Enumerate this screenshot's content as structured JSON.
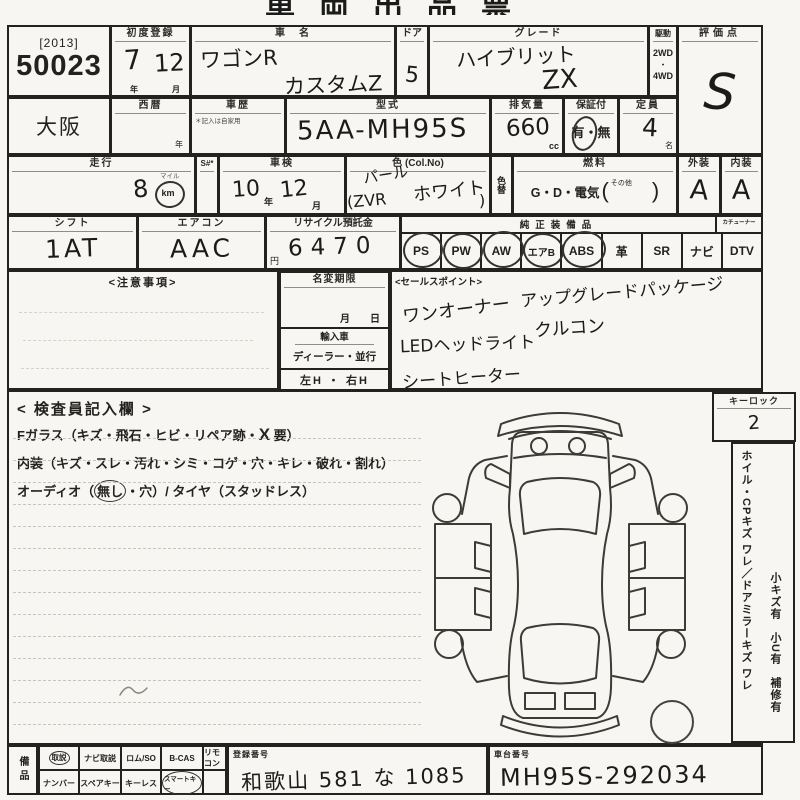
{
  "colors": {
    "paper": "#f7f6f2",
    "ink": "#1b1b19",
    "line": "#23221f",
    "faint_line": "#c7c6be"
  },
  "title": "車両出品票",
  "lot": {
    "year_bracket": "[2013]",
    "number": "50023"
  },
  "auction_house": "大阪",
  "first_registration": {
    "label": "初度登録",
    "year": "7",
    "month": "12",
    "year_unit": "年",
    "month_unit": "月"
  },
  "car_name": {
    "label": "車　名",
    "line1": "ワゴンR",
    "line2": "カスタムZ"
  },
  "door": {
    "label": "ドア",
    "value": "5"
  },
  "grade": {
    "label": "グレード",
    "line1": "ハイブリット",
    "line2": "ZX"
  },
  "drive": {
    "label": "駆動",
    "opt1": "2WD",
    "dot": "・",
    "opt2": "4WD"
  },
  "score": {
    "label": "評価点",
    "value": "S"
  },
  "seireki": {
    "label": "西暦",
    "unit": "年"
  },
  "car_history": {
    "label": "車歴",
    "note": "＊記入は自家用"
  },
  "model_code": {
    "label": "型式",
    "value": "5AA-MH95S"
  },
  "displacement": {
    "label": "排気量",
    "value": "660",
    "unit": "cc"
  },
  "warranty": {
    "label": "保証付",
    "value": "有・無"
  },
  "capacity": {
    "label": "定員",
    "value": "4",
    "unit": "名"
  },
  "mileage": {
    "label": "走行",
    "s_label": "S#*",
    "value": "8",
    "mile_label": "マイル",
    "km_label": "km"
  },
  "shaken": {
    "label": "車検",
    "year": "10",
    "year_unit": "年",
    "month": "12",
    "month_unit": "月"
  },
  "color": {
    "label": "色 (Col.No)",
    "line1": "パール",
    "line2": "ホワイト",
    "code": "(ZVR",
    "close_paren": ")"
  },
  "color_change_label": "色替",
  "fuel": {
    "label": "燃料",
    "value": "G・D・電気",
    "open": "(",
    "other": "その他",
    "close": ")"
  },
  "exterior": {
    "label": "外装",
    "value": "A"
  },
  "interior": {
    "label": "内装",
    "value": "A"
  },
  "shift": {
    "label": "シフト",
    "value": "1AT"
  },
  "aircon": {
    "label": "エアコン",
    "value": "AAC"
  },
  "recycle": {
    "label": "リサイクル預託金",
    "value": "6470",
    "unit": "円"
  },
  "equipment": {
    "label": "純正装備品",
    "tuner_label": "カチューナー",
    "items": [
      {
        "label": "PS",
        "circled": true
      },
      {
        "label": "PW",
        "circled": true
      },
      {
        "label": "AW",
        "circled": true
      },
      {
        "label": "エアB",
        "circled": true
      },
      {
        "label": "ABS",
        "circled": true
      },
      {
        "label": "革",
        "circled": false
      },
      {
        "label": "SR",
        "circled": false
      },
      {
        "label": "ナビ",
        "circled": false
      },
      {
        "label": "DTV",
        "circled": false
      }
    ]
  },
  "notes": {
    "label": "<注意事項>"
  },
  "name_change": {
    "label": "名変期限",
    "date_line": "月　　日",
    "import_label": "輸入車",
    "dealer_line": "ディーラー・並行",
    "handle_line": "左H ・ 右H"
  },
  "sales_points": {
    "label": "<セールスポイント>",
    "items": [
      "アップグレードパッケージ",
      "ワンオーナー",
      "クルコン",
      "LEDヘッドライト",
      "シートヒーター"
    ]
  },
  "inspector": {
    "label": "< 検査員記入欄 >",
    "line1_prefix": "Fガラス（キズ・飛石・ヒビ・リペア跡・",
    "line1_mark": "X",
    "line1_suffix": "要）",
    "line2": "内装（キズ・スレ・汚れ・シミ・コゲ・穴・キレ・破れ・割れ）",
    "line3_prefix": "オーディオ（",
    "line3_circled": "無し",
    "line3_suffix": "・穴）/ タイヤ（スタッドレス）"
  },
  "key_lock": {
    "label": "キーロック",
    "value": "2"
  },
  "side_notes": {
    "line1": "ホイル・CPキズ ワレ／ドアミラーキズ ワレ",
    "line2": "小キズ有　小U有　補修有"
  },
  "bottom": {
    "equip_label": "備品",
    "row1": [
      "取説",
      "ナビ取説",
      "ロム/SO",
      "B-CAS",
      "リモコン"
    ],
    "row2": [
      "ナンバー",
      "スペアキー",
      "キーレス",
      "スマートキー",
      ""
    ],
    "registration": {
      "label": "登録番号",
      "value": "和歌山 581 な 1085"
    },
    "chassis": {
      "label": "車台番号",
      "value": "MH95S-292034"
    }
  }
}
